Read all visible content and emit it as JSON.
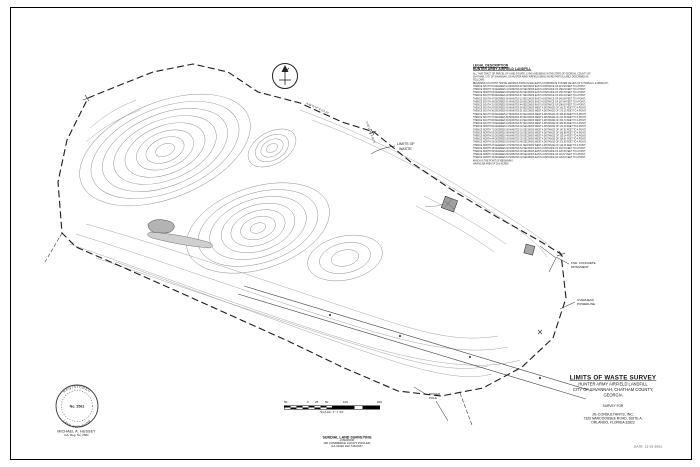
{
  "sheet": {
    "date": "DATE: 12-15-2003"
  },
  "legal_description": {
    "heading1": "LEGAL DESCRIPTION",
    "heading2": "HUNTER ARMY AIRFIELD LANDFILL",
    "body_lines": [
      "ALL THAT TRACT OR PARCEL OF LAND SITUATE, LYING AND BEING IN THE STATE OF GEORGIA, COUNTY OF",
      "CHATHAM, CITY OF SAVANNAH, ON HUNTER ARMY AIRFIELD BEING MORE PARTICULARLY DESCRIBED AS",
      "FOLLOWS:",
      "BEGINNING AT A POINT HAVING GEORGIA STATE PLANE (EAST) COORDINATE SYSTEM VALUES OF N 756354.21, E 965412.87;",
      "THENCE SOUTH 81 DEGREES 14 MINUTES 32 SECONDS EAST A DISTANCE OF 214.56 FEET TO A POINT;",
      "THENCE NORTH 72 DEGREES 41 MINUTES 18 SECONDS EAST A DISTANCE OF 188.23 FEET TO A POINT;",
      "THENCE NORTH 64 DEGREES 09 MINUTES 55 SECONDS EAST A DISTANCE OF 156.78 FEET TO A POINT;",
      "THENCE SOUTH 58 DEGREES 22 MINUTES 47 SECONDS EAST A DISTANCE OF 203.41 FEET TO A POINT;",
      "THENCE SOUTH 47 DEGREES 36 MINUTES 12 SECONDS EAST A DISTANCE OF 245.09 FEET TO A POINT;",
      "THENCE SOUTH 39 DEGREES 51 MINUTES 28 SECONDS EAST A DISTANCE OF 167.84 FEET TO A POINT;",
      "THENCE SOUTH 31 DEGREES 05 MINUTES 44 SECONDS EAST A DISTANCE OF 198.62 FEET TO A POINT;",
      "THENCE SOUTH 24 DEGREES 18 MINUTES 09 SECONDS WEST A DISTANCE OF 142.37 FEET TO A POINT;",
      "THENCE SOUTH 36 DEGREES 42 MINUTES 51 SECONDS WEST A DISTANCE OF 176.15 FEET TO A POINT;",
      "THENCE SOUTH 49 DEGREES 27 MINUTES 33 SECONDS WEST A DISTANCE OF 189.90 FEET TO A POINT;",
      "THENCE SOUTH 57 DEGREES 58 MINUTES 06 SECONDS WEST A DISTANCE OF 221.48 FEET TO A POINT;",
      "THENCE SOUTH 66 DEGREES 31 MINUTES 24 SECONDS WEST A DISTANCE OF 154.73 FEET TO A POINT;",
      "THENCE SOUTH 74 DEGREES 44 MINUTES 57 SECONDS WEST A DISTANCE OF 182.06 FEET TO A POINT;",
      "THENCE NORTH 82 DEGREES 13 MINUTES 40 SECONDS WEST A DISTANCE OF 173.29 FEET TO A POINT;",
      "THENCE NORTH 71 DEGREES 55 MINUTES 16 SECONDS WEST A DISTANCE OF 147.52 FEET TO A POINT;",
      "THENCE NORTH 63 DEGREES 08 MINUTES 02 SECONDS WEST A DISTANCE OF 165.88 FEET TO A POINT;",
      "THENCE NORTH 52 DEGREES 46 MINUTES 39 SECONDS WEST A DISTANCE OF 139.14 FEET TO A POINT;",
      "THENCE NORTH 44 DEGREES 20 MINUTES 25 SECONDS WEST A DISTANCE OF 158.61 FEET TO A POINT;",
      "THENCE NORTH 35 DEGREES 53 MINUTES 48 SECONDS WEST A DISTANCE OF 171.93 FEET TO A POINT;",
      "THENCE NORTH 27 DEGREES 37 MINUTES 11 SECONDS WEST A DISTANCE OF 144.26 FEET TO A POINT;",
      "THENCE NORTH 18 DEGREES 02 MINUTES 54 SECONDS EAST A DISTANCE OF 132.70 FEET TO A POINT;",
      "THENCE NORTH 09 DEGREES 29 MINUTES 36 SECONDS EAST A DISTANCE OF 128.45 FEET TO A POINT;",
      "THENCE NORTH 21 DEGREES 50 MINUTES 08 SECONDS EAST A DISTANCE OF 119.57 FEET TO A POINT;",
      "THENCE NORTH 33 DEGREES 16 MINUTES 43 SECONDS EAST A DISTANCE OF 126.81 FEET TO A POINT;",
      "WHICH IS THE POINT OF BEGINNING.",
      "HAVING AN AREA OF 28.6 ACRES"
    ]
  },
  "title_block": {
    "title": "LIMITS OF WASTE SURVEY",
    "line1": "HUNTER ARMY AIRFIELD LANDFILL",
    "line2": "CITY OF SAVANNAH, CHATHAM COUNTY,",
    "line3": "GEORGIA",
    "survey_for_label": "SURVEY FOR",
    "client_name": "JG CONSULTANTS, INC.",
    "client_address1": "7320 NARCOOSSEE ROAD, SUITE A,",
    "client_address2": "ORLANDO, FLORIDA 32822"
  },
  "surveyor": {
    "name": "MICHAEL A. HUSSEY",
    "registration": "GA. Reg. No. 2561",
    "seal_number": "No. 2561",
    "seal_text_top": "REGISTERED",
    "seal_text_bottom": "LAND SURVEYOR"
  },
  "firm": {
    "name": "SUNDIAL LAND SURVEYING",
    "line2": "LONGWOOD",
    "line3": "100 COMMERCE COURT POOLER,",
    "line4": "GA 31322 912-748-0347"
  },
  "scale_bar": {
    "labels": [
      "50",
      "0",
      "25",
      "50",
      "100",
      "200"
    ],
    "caption": "SCALE: 1\" = 50'"
  },
  "map": {
    "limits_label_line1": "LIMITS OF",
    "limits_label_line2": "WASTE",
    "monument_label_line1": "FND. CONCRETE",
    "monument_label_line2": "MONUMENT",
    "powerline_label_line1": "OVERHEAD",
    "powerline_label_line2": "POWERLINE",
    "pole_label_line1": "POWER",
    "pole_label_line2": "POLE",
    "bearing_label_1": "N 05°12'44\" E  98.76'",
    "bearing_label_2": "N 88°31'07\" E  212.40'"
  }
}
